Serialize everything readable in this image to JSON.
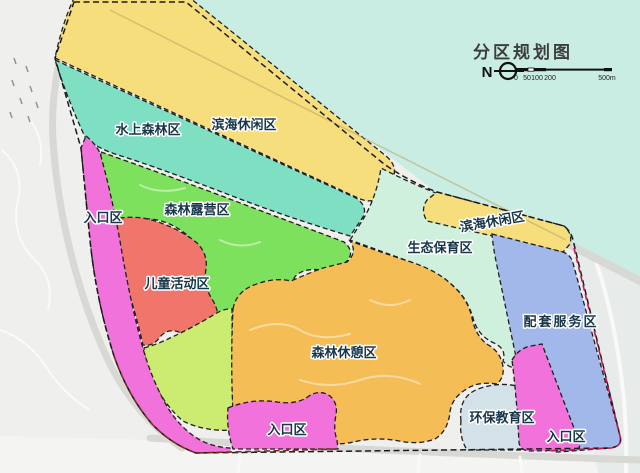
{
  "map": {
    "title": "分区规划图",
    "north_label": "N",
    "scale": {
      "ticks": [
        "0",
        "50",
        "100",
        "200"
      ],
      "end_label": "500m"
    }
  },
  "zones": {
    "binhai_band": {
      "label": "滨海休闲区",
      "color": "#F6DE7D"
    },
    "binhai_east": {
      "label": "滨海休闲区",
      "color": "#F6DE7D"
    },
    "shuishang_senlin": {
      "label": "水上森林区",
      "color": "#7FDFC2"
    },
    "senlin_luying": {
      "label": "森林露营区",
      "color": "#7EE15E"
    },
    "rukou_west": {
      "label": "入口区",
      "color": "#F172DA"
    },
    "ertong_huodong": {
      "label": "儿童活动区",
      "color": "#F0766B"
    },
    "shengtai_baoyu": {
      "label": "生态保育区",
      "color": "#CFF0DC"
    },
    "senlin_xiuqi": {
      "label": "森林休憩区",
      "color": "#F5BD55"
    },
    "peitao_fuwu": {
      "label": "配套服务区",
      "color": "#A2B8EA"
    },
    "huanbao_jiaoyu": {
      "label": "环保教育区",
      "color": "#D3E2E8"
    },
    "rukou_south": {
      "label": "入口区",
      "color": "#F172DA"
    },
    "rukou_east": {
      "label": "入口区",
      "color": "#F172DA"
    },
    "green_buffer": {
      "color": "#CBEC70"
    }
  },
  "base": {
    "water": "#C9EDE2",
    "land": "#EFEFED",
    "east_land": "#E7EBEA",
    "boundary_east": "#C2185B",
    "boundary_south": "#7A2F23"
  }
}
